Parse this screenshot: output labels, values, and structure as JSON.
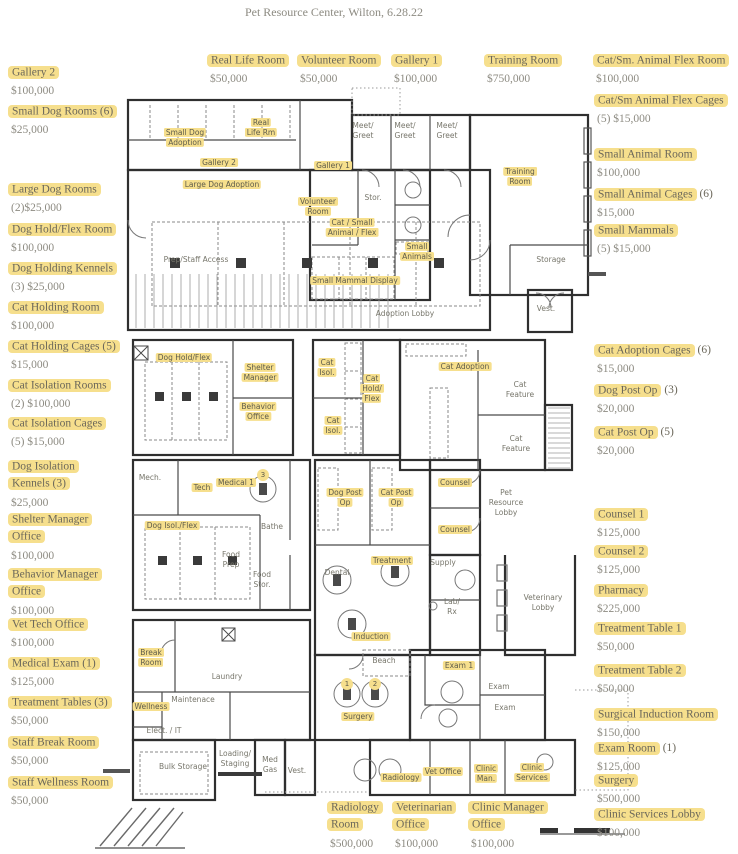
{
  "title": "Pet Resource Center, Wilton, 6.28.22",
  "colors": {
    "highlight": "#f6df8d",
    "label_text": "#6b675a",
    "price_text": "#8d8b82",
    "wall": "#2f2f2f"
  },
  "callouts": [
    {
      "name": "Gallery 2",
      "price": "$100,000",
      "x": 8,
      "y": 64,
      "w": 130
    },
    {
      "name": "Small Dog Rooms (6)",
      "price": "$25,000",
      "x": 8,
      "y": 103,
      "w": 130
    },
    {
      "name": "Large Dog Rooms",
      "price": "(2)$25,000",
      "x": 8,
      "y": 181,
      "w": 130
    },
    {
      "name": "Dog Hold/Flex Room",
      "price": "$100,000",
      "x": 8,
      "y": 221,
      "w": 135
    },
    {
      "name": "Dog Holding Kennels",
      "price": "(3) $25,000",
      "x": 8,
      "y": 260,
      "w": 135
    },
    {
      "name": "Cat Holding Room",
      "price": "$100,000",
      "x": 8,
      "y": 299,
      "w": 130
    },
    {
      "name": "Cat Holding Cages (5)",
      "price": "$15,000",
      "x": 8,
      "y": 338,
      "w": 140
    },
    {
      "name": "Cat Isolation Rooms",
      "price": "(2) $100,000",
      "x": 8,
      "y": 377,
      "w": 135
    },
    {
      "name": "Cat Isolation Cages",
      "price": "(5) $15,000",
      "x": 8,
      "y": 415,
      "w": 135
    },
    {
      "name": "Dog Isolation Kennels (3)",
      "price": "$25,000",
      "x": 8,
      "y": 458,
      "w": 95
    },
    {
      "name": "Shelter Manager Office",
      "price": "$100,000",
      "x": 8,
      "y": 511,
      "w": 110
    },
    {
      "name": "Behavior Manager Office",
      "price": "$100,000",
      "x": 8,
      "y": 566,
      "w": 115
    },
    {
      "name": "Vet Tech Office",
      "price": "$100,000",
      "x": 8,
      "y": 616,
      "w": 130
    },
    {
      "name": "Medical Exam (1)",
      "price": "$125,000",
      "x": 8,
      "y": 655,
      "w": 130
    },
    {
      "name": "Treatment Tables (3)",
      "price": "$50,000",
      "x": 8,
      "y": 694,
      "w": 140
    },
    {
      "name": "Staff Break Room",
      "price": "$50,000",
      "x": 8,
      "y": 734,
      "w": 130
    },
    {
      "name": "Staff Wellness Room",
      "price": "$50,000",
      "x": 8,
      "y": 774,
      "w": 140
    },
    {
      "name": "Real Life Room",
      "price": "$50,000",
      "x": 207,
      "y": 52,
      "w": 110
    },
    {
      "name": "Volunteer Room",
      "price": "$50,000",
      "x": 297,
      "y": 52,
      "w": 115
    },
    {
      "name": "Gallery 1",
      "price": "$100,000",
      "x": 391,
      "y": 52,
      "w": 80
    },
    {
      "name": "Training Room",
      "price": "$750,000",
      "x": 484,
      "y": 52,
      "w": 110
    },
    {
      "name": "Cat/Sm. Animal Flex Room",
      "price": "$100,000",
      "x": 593,
      "y": 52,
      "w": 150
    },
    {
      "name": "Cat/Sm Animal Flex Cages",
      "price": "(5) $15,000",
      "x": 594,
      "y": 92,
      "w": 150
    },
    {
      "name": "Small Animal Room",
      "price": "$100,000",
      "x": 594,
      "y": 146,
      "w": 150
    },
    {
      "name": "Small Animal Cages",
      "suffix": "(6)",
      "price": "$15,000",
      "x": 594,
      "y": 186,
      "w": 150
    },
    {
      "name": "Small Mammals",
      "price": "(5) $15,000",
      "x": 594,
      "y": 222,
      "w": 150
    },
    {
      "name": "Cat Adoption Cages",
      "suffix": "(6)",
      "price": "$15,000",
      "x": 594,
      "y": 342,
      "w": 150
    },
    {
      "name": "Dog Post Op",
      "suffix": "(3)",
      "price": "$20,000",
      "x": 594,
      "y": 382,
      "w": 150
    },
    {
      "name": "Cat Post Op",
      "suffix": "(5)",
      "price": "$20,000",
      "x": 594,
      "y": 424,
      "w": 150
    },
    {
      "name": "Counsel 1",
      "price": "$125,000",
      "x": 594,
      "y": 506,
      "w": 150
    },
    {
      "name": "Counsel 2",
      "price": "$125,000",
      "x": 594,
      "y": 543,
      "w": 150
    },
    {
      "name": "Pharmacy",
      "price": "$225,000",
      "x": 594,
      "y": 582,
      "w": 150
    },
    {
      "name": "Treatment Table 1",
      "price": "$50,000",
      "x": 594,
      "y": 620,
      "w": 150
    },
    {
      "name": "Treatment Table 2",
      "price": "$50,000",
      "x": 594,
      "y": 662,
      "w": 150
    },
    {
      "name": "Surgical Induction Room",
      "price": "$150,000",
      "x": 594,
      "y": 706,
      "w": 150
    },
    {
      "name": "Exam Room",
      "suffix": "(1)",
      "price": "$125,000",
      "x": 594,
      "y": 740,
      "w": 150
    },
    {
      "name": "Surgery",
      "price": "$500,000",
      "x": 594,
      "y": 772,
      "w": 150
    },
    {
      "name": "Clinic Services Lobby",
      "price": "$100,000",
      "x": 594,
      "y": 806,
      "w": 150
    },
    {
      "name": "Radiology Room",
      "price": "$500,000",
      "x": 327,
      "y": 799,
      "w": 72
    },
    {
      "name": "Veterinarian Office",
      "price": "$100,000",
      "x": 392,
      "y": 799,
      "w": 95
    },
    {
      "name": "Clinic Manager Office",
      "price": "$100,000",
      "x": 468,
      "y": 799,
      "w": 105
    }
  ],
  "plan_labels": [
    {
      "text": "Small Dog\nAdoption",
      "x": 185,
      "y": 138,
      "hl": true
    },
    {
      "text": "Real\nLife Rm",
      "x": 261,
      "y": 128,
      "hl": true
    },
    {
      "text": "Gallery 2",
      "x": 219,
      "y": 163,
      "hl": true
    },
    {
      "text": "Large Dog Adoption",
      "x": 222,
      "y": 185,
      "hl": true
    },
    {
      "text": "Gallery 1",
      "x": 333,
      "y": 166,
      "hl": true
    },
    {
      "text": "Volunteer\nRoom",
      "x": 318,
      "y": 207,
      "hl": true
    },
    {
      "text": "Cat / Small\nAnimal / Flex",
      "x": 352,
      "y": 228,
      "hl": true
    },
    {
      "text": "Small\nAnimals",
      "x": 417,
      "y": 252,
      "hl": true
    },
    {
      "text": "Small Mammal Display",
      "x": 355,
      "y": 281,
      "hl": true
    },
    {
      "text": "Training\nRoom",
      "x": 520,
      "y": 177,
      "hl": true
    },
    {
      "text": "Dog Hold/Flex",
      "x": 184,
      "y": 358,
      "hl": true
    },
    {
      "text": "Shelter\nManager",
      "x": 260,
      "y": 373,
      "hl": true
    },
    {
      "text": "Behavior\nOffice",
      "x": 258,
      "y": 412,
      "hl": true
    },
    {
      "text": "Cat\nIsol.",
      "x": 327,
      "y": 368,
      "hl": true
    },
    {
      "text": "Cat\nIsol.",
      "x": 333,
      "y": 426,
      "hl": true
    },
    {
      "text": "Cat\nHold/\nFlex",
      "x": 372,
      "y": 389,
      "hl": true
    },
    {
      "text": "Cat Adoption",
      "x": 465,
      "y": 367,
      "hl": true
    },
    {
      "text": "Tech",
      "x": 202,
      "y": 488,
      "hl": true
    },
    {
      "text": "Medical 1",
      "x": 236,
      "y": 483,
      "hl": true
    },
    {
      "text": "Dog Isol./Flex",
      "x": 172,
      "y": 526,
      "hl": true
    },
    {
      "text": "Dog Post\nOp",
      "x": 345,
      "y": 498,
      "hl": true
    },
    {
      "text": "Cat Post\nOp",
      "x": 396,
      "y": 498,
      "hl": true
    },
    {
      "text": "Counsel",
      "x": 455,
      "y": 483,
      "hl": true
    },
    {
      "text": "Counsel",
      "x": 455,
      "y": 530,
      "hl": true
    },
    {
      "text": "Treatment",
      "x": 392,
      "y": 561,
      "hl": true
    },
    {
      "text": "Induction",
      "x": 371,
      "y": 637,
      "hl": true
    },
    {
      "text": "Exam 1",
      "x": 459,
      "y": 666,
      "hl": true
    },
    {
      "text": "Break\nRoom",
      "x": 151,
      "y": 658,
      "hl": true
    },
    {
      "text": "Wellness",
      "x": 151,
      "y": 707,
      "hl": true
    },
    {
      "text": "Surgery",
      "x": 358,
      "y": 717,
      "hl": true
    },
    {
      "text": "Radiology",
      "x": 401,
      "y": 778,
      "hl": true
    },
    {
      "text": "Vet Office",
      "x": 443,
      "y": 772,
      "hl": true
    },
    {
      "text": "Clinic\nMan.",
      "x": 486,
      "y": 774,
      "hl": true
    },
    {
      "text": "Clinic\nServices",
      "x": 532,
      "y": 773,
      "hl": true
    },
    {
      "text": "Meet/\nGreet",
      "x": 363,
      "y": 131,
      "hl": false
    },
    {
      "text": "Meet/\nGreet",
      "x": 405,
      "y": 131,
      "hl": false
    },
    {
      "text": "Meet/\nGreet",
      "x": 447,
      "y": 131,
      "hl": false
    },
    {
      "text": "Stor.",
      "x": 373,
      "y": 198,
      "hl": false
    },
    {
      "text": "Storage",
      "x": 551,
      "y": 260,
      "hl": false
    },
    {
      "text": "Vest.",
      "x": 546,
      "y": 309,
      "hl": false
    },
    {
      "text": "Adoption Lobby",
      "x": 405,
      "y": 314,
      "hl": false
    },
    {
      "text": "Prep/Staff Access",
      "x": 196,
      "y": 260,
      "hl": false
    },
    {
      "text": "Cat\nFeature",
      "x": 520,
      "y": 390,
      "hl": false
    },
    {
      "text": "Cat\nFeature",
      "x": 516,
      "y": 444,
      "hl": false
    },
    {
      "text": "Mech.",
      "x": 150,
      "y": 478,
      "hl": false
    },
    {
      "text": "Bathe",
      "x": 272,
      "y": 527,
      "hl": false
    },
    {
      "text": "Food\nPrep",
      "x": 231,
      "y": 560,
      "hl": false
    },
    {
      "text": "Food\nStor.",
      "x": 262,
      "y": 580,
      "hl": false
    },
    {
      "text": "Pet\nResource\nLobby",
      "x": 506,
      "y": 503,
      "hl": false
    },
    {
      "text": "Supply",
      "x": 443,
      "y": 563,
      "hl": false
    },
    {
      "text": "Dental",
      "x": 337,
      "y": 573,
      "hl": false
    },
    {
      "text": "Lab/\nRx",
      "x": 452,
      "y": 607,
      "hl": false
    },
    {
      "text": "Veterinary\nLobby",
      "x": 543,
      "y": 603,
      "hl": false
    },
    {
      "text": "Beach",
      "x": 384,
      "y": 661,
      "hl": false
    },
    {
      "text": "Exam",
      "x": 499,
      "y": 687,
      "hl": false
    },
    {
      "text": "Exam",
      "x": 505,
      "y": 708,
      "hl": false
    },
    {
      "text": "Laundry",
      "x": 227,
      "y": 677,
      "hl": false
    },
    {
      "text": "Maintenace",
      "x": 193,
      "y": 700,
      "hl": false
    },
    {
      "text": "Elect. / IT",
      "x": 164,
      "y": 731,
      "hl": false
    },
    {
      "text": "Bulk Storage",
      "x": 183,
      "y": 767,
      "hl": false
    },
    {
      "text": "Loading/\nStaging",
      "x": 235,
      "y": 759,
      "hl": false
    },
    {
      "text": "Med\nGas",
      "x": 270,
      "y": 765,
      "hl": false
    },
    {
      "text": "Vest.",
      "x": 297,
      "y": 771,
      "hl": false
    }
  ],
  "plan_markers": [
    {
      "text": "3",
      "x": 263,
      "y": 475
    },
    {
      "text": "1",
      "x": 347,
      "y": 684
    },
    {
      "text": "2",
      "x": 375,
      "y": 684
    }
  ]
}
